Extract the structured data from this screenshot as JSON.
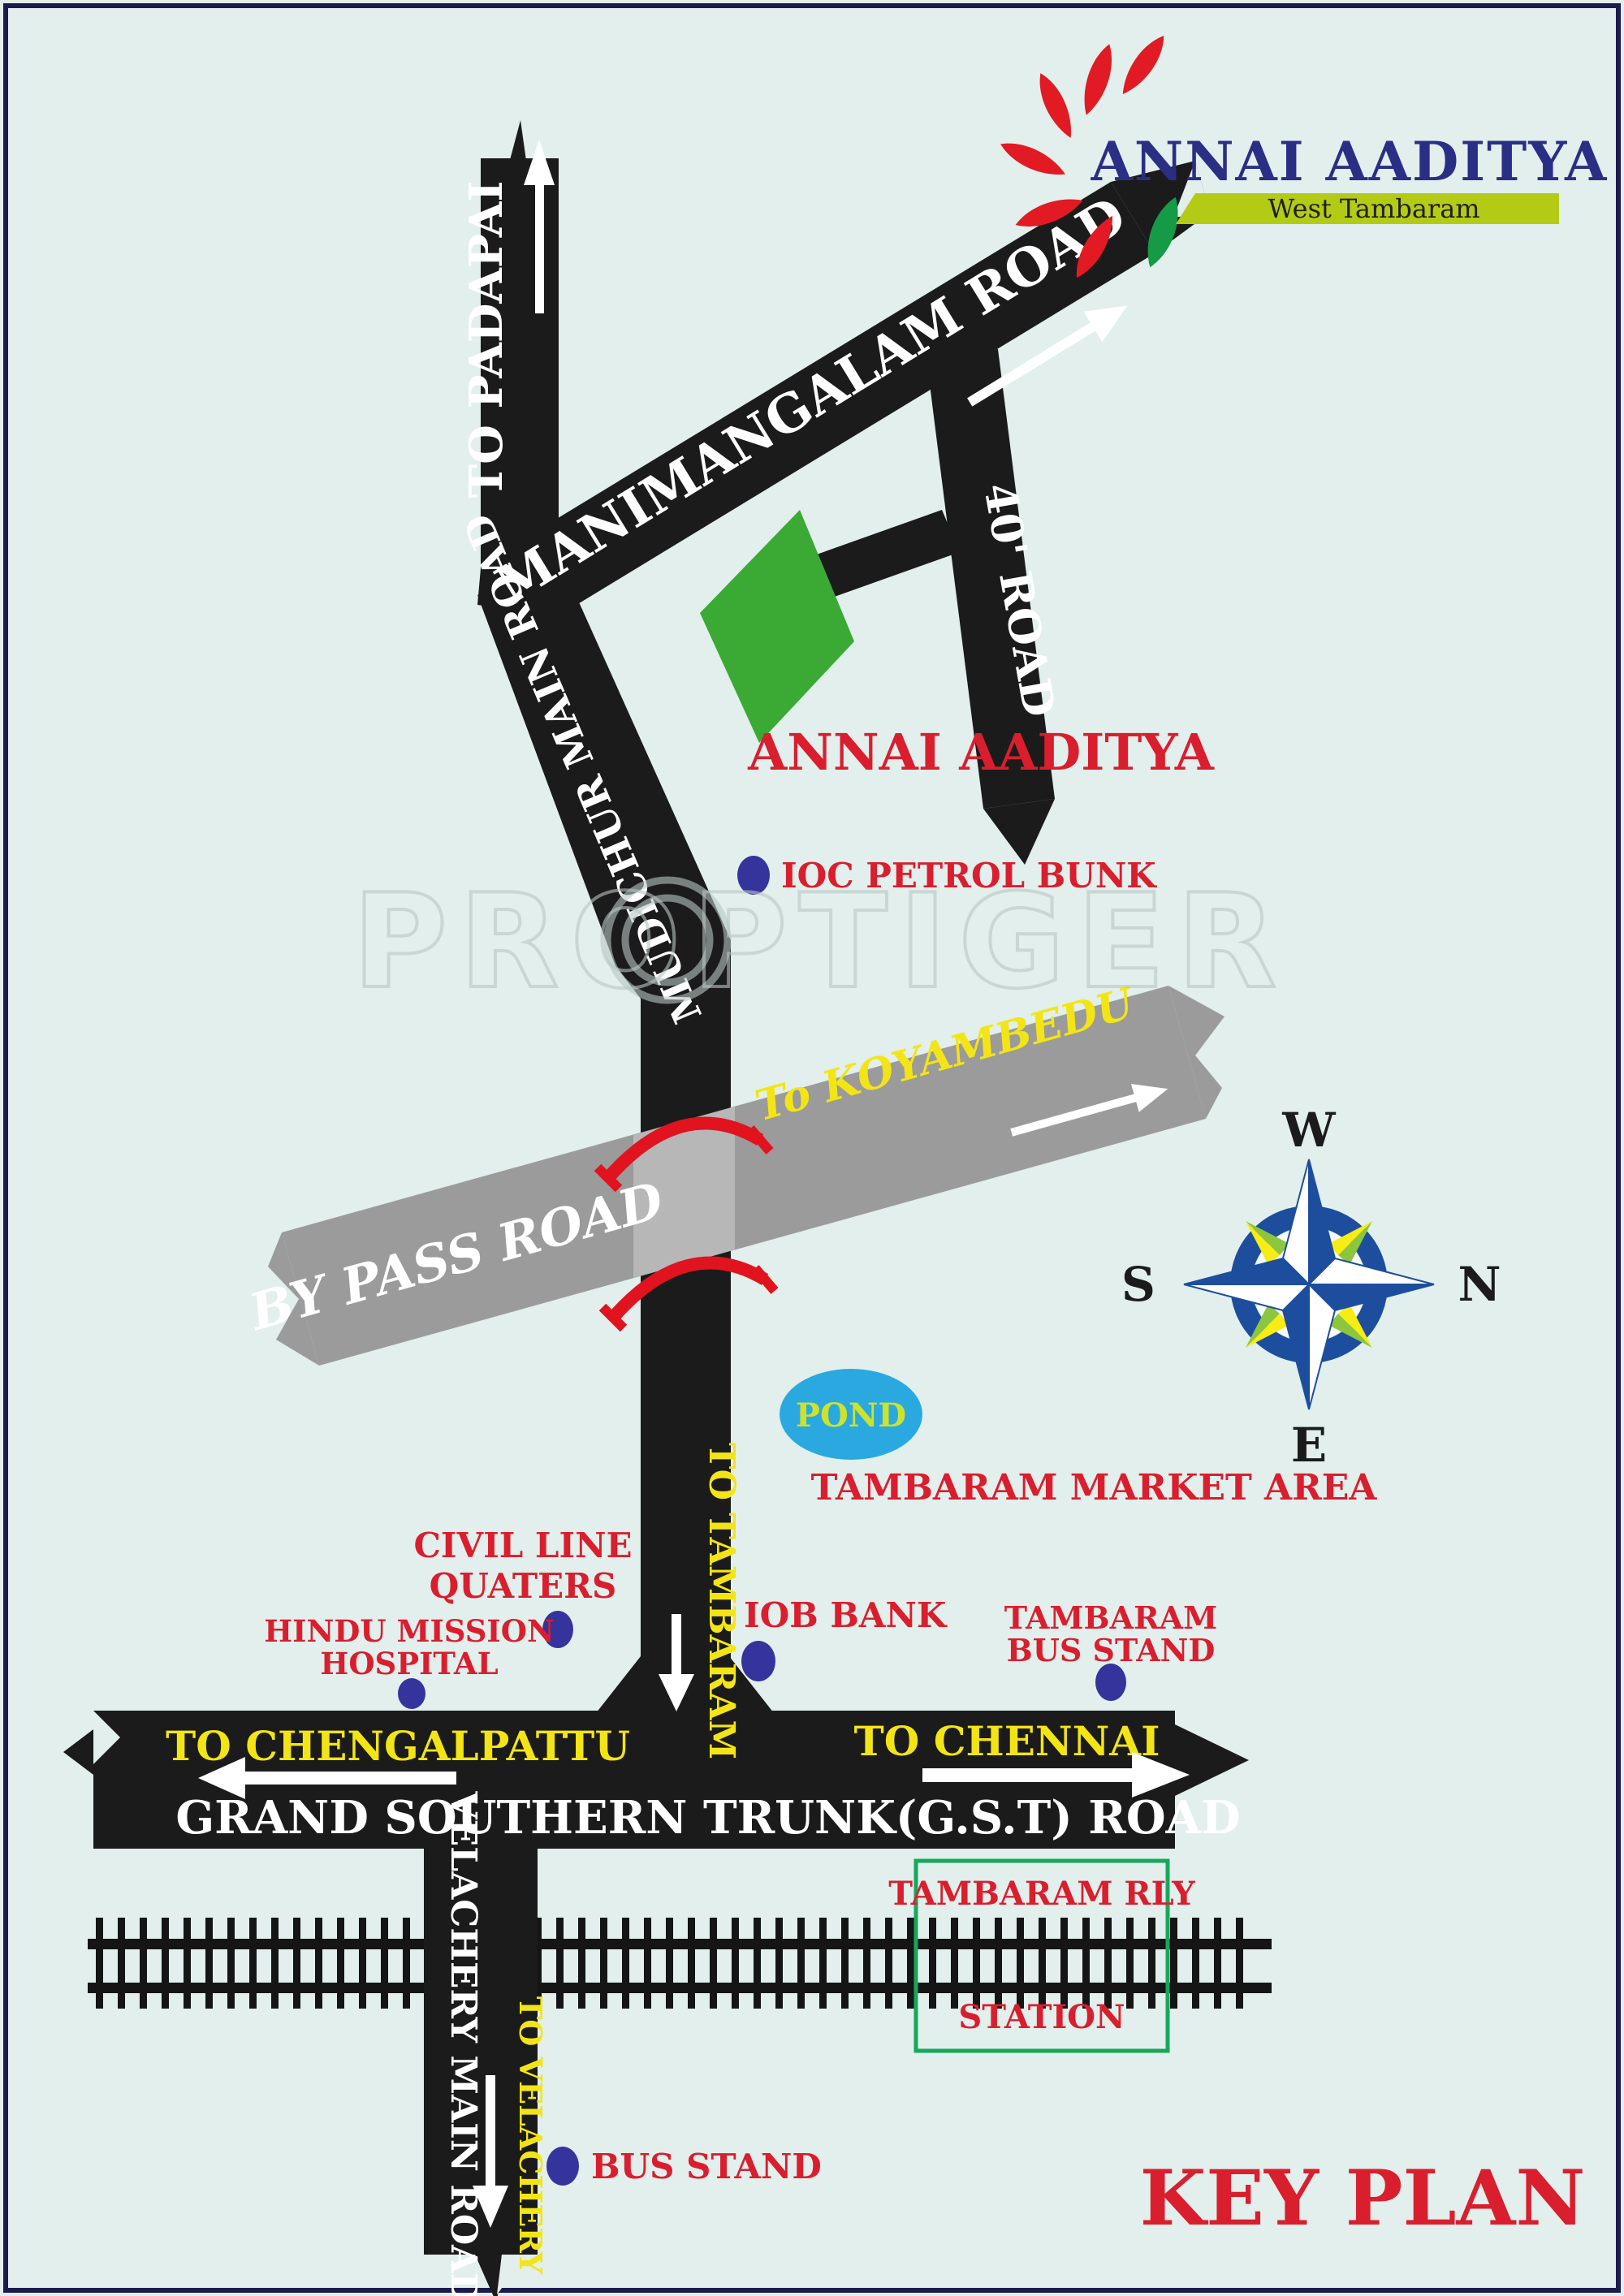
{
  "page": {
    "background": "#e2efec",
    "border_color": "#1b1b4d"
  },
  "logo": {
    "title": "ANNAI AADITYA",
    "subtitle": "West Tambaram",
    "title_color": "#2b2e85",
    "banner_color": "#b4cb15",
    "petal_color": "#e11a23",
    "leaf_color": "#159a46"
  },
  "watermark": {
    "text": "PROPTIGER"
  },
  "plot": {
    "label": "ANNAI AADITYA",
    "color": "#3aaa35"
  },
  "roads": {
    "to_padapai": {
      "label": "TO PADAPAI"
    },
    "manimangalam": {
      "label": "MANIMANGALAM ROAD"
    },
    "forty_road": {
      "label": "40' ROAD"
    },
    "mudichur": {
      "label": "MUDICHUR MAIN ROAD"
    },
    "bypass": {
      "label": "BY PASS ROAD",
      "to": "To KOYAMBEDU",
      "color": "#9b9b9b"
    },
    "to_tambaram": {
      "label": "TO TAMBARAM"
    },
    "gst": {
      "label": "GRAND SOUTHERN TRUNK(G.S.T) ROAD",
      "left": "TO CHENGALPATTU",
      "right": "TO CHENNAI"
    },
    "velachery": {
      "label": "VELACHERY MAIN ROAD",
      "to": "TO VELACHERY"
    }
  },
  "landmarks": {
    "ioc": "IOC PETROL BUNK",
    "pond": "POND",
    "market": "TAMBARAM MARKET AREA",
    "civil_line_1": "CIVIL LINE",
    "civil_line_2": "QUATERS",
    "iob": "IOB BANK",
    "hindu_1": "HINDU MISSION",
    "hindu_2": "HOSPITAL",
    "tbs_1": "TAMBARAM",
    "tbs_2": "BUS STAND",
    "rly_1": "TAMBARAM RLY",
    "rly_2": "STATION",
    "bus_stand": "BUS STAND"
  },
  "compass": {
    "w": "W",
    "n": "N",
    "s": "S",
    "e": "E"
  },
  "footer": {
    "key_plan": "KEY PLAN"
  },
  "colors": {
    "road_black": "#1b1b1b",
    "red_text": "#d91e2e",
    "yellow_text": "#f3e515",
    "dot_blue": "#34349c",
    "pond_blue": "#2aa9e0",
    "pond_text": "#cde22b",
    "station_box_green": "#16a85a",
    "compass_blue": "#1d4e9e"
  }
}
